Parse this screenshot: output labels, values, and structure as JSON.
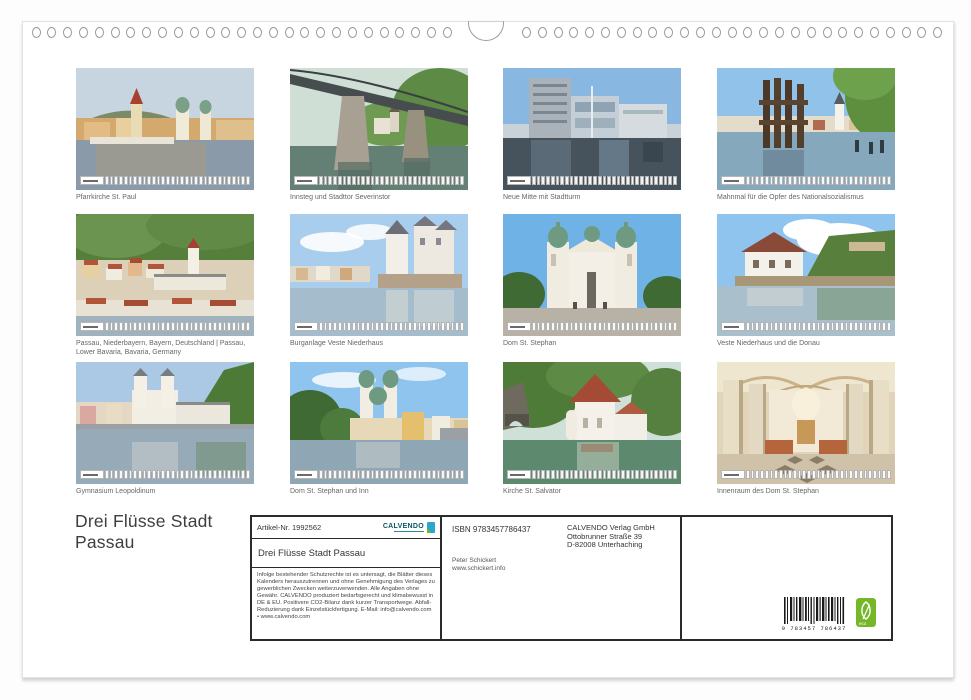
{
  "page": {
    "big_title": "Drei Flüsse Stadt\nPassau"
  },
  "colors": {
    "calvendo_teal": "#0b5560",
    "eco_green": "#76b72a",
    "box_border": "#2b2b2b"
  },
  "thumbnails": [
    {
      "caption": "Pfarrkirche St. Paul"
    },
    {
      "caption": "Innsteg und Stadttor Severinstor"
    },
    {
      "caption": "Neue Mitte mit Stadtturm"
    },
    {
      "caption": "Mahnmal für die Opfer des Nationalsozialismus"
    },
    {
      "caption": "Passau, Niederbayern, Bayern, Deutschland | Passau, Lower Bavaria, Bavaria, Germany"
    },
    {
      "caption": "Burganlage Veste Niederhaus"
    },
    {
      "caption": "Dom St. Stephan"
    },
    {
      "caption": "Veste Niederhaus und die Donau"
    },
    {
      "caption": "Gymnasium Leopoldinum"
    },
    {
      "caption": "Dom St. Stephan und Inn"
    },
    {
      "caption": "Kirche St. Salvator"
    },
    {
      "caption": "Innenraum des Dom St. Stephan"
    }
  ],
  "info": {
    "artikel": "Artikel-Nr. 1992562",
    "brand": "CALVENDO",
    "product_title": "Drei Flüsse Stadt Passau",
    "legal_text": "Infolge bestehender Schutzrechte ist es untersagt, die Blätter dieses Kalenders herauszutrennen und ohne Genehmigung des Verlages zu gewerblichen Zwecken weiterzuverwenden. Alle Angaben ohne Gewähr. CALVENDO produziert bedarfsgerecht und klimabewusst in DE & EU. Positivere CO2-Bilanz dank kurzer Transportwege. Abfall-Reduzierung dank Einzelstückfertigung. E-Mail: info@calvendo.com • www.calvendo.com",
    "isbn": "ISBN 9783457786437",
    "publisher_lines": [
      "CALVENDO Verlag GmbH",
      "Ottobrunner Straße 39",
      "D-82008 Unterhaching"
    ],
    "photographer_lines": [
      "Peter Schickert",
      "www.schickert.info"
    ],
    "barcode_digits": "9 783457 786437",
    "eco_label": "eco"
  }
}
